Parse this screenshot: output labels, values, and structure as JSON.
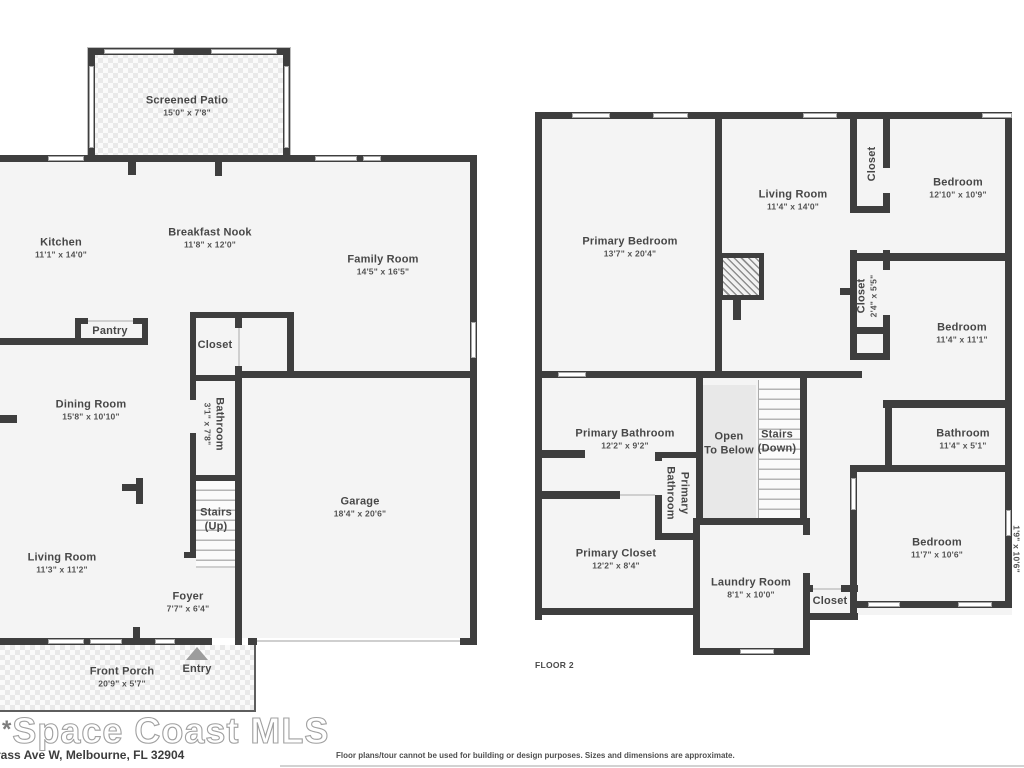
{
  "floor1": {
    "rooms": {
      "screened_patio": {
        "name": "Screened Patio",
        "dims": "15'0\" x 7'8\""
      },
      "kitchen": {
        "name": "Kitchen",
        "dims": "11'1\" x 14'0\""
      },
      "breakfast_nook": {
        "name": "Breakfast Nook",
        "dims": "11'8\" x 12'0\""
      },
      "family_room": {
        "name": "Family Room",
        "dims": "14'5\" x 16'5\""
      },
      "pantry": {
        "name": "Pantry"
      },
      "closet": {
        "name": "Closet"
      },
      "dining_room": {
        "name": "Dining Room",
        "dims": "15'8\" x 10'10\""
      },
      "bathroom": {
        "name": "Bathroom",
        "dims": "3'1\" x 7'8\""
      },
      "stairs": {
        "name": "Stairs",
        "dims": "(Up)"
      },
      "garage": {
        "name": "Garage",
        "dims": "18'4\" x 20'6\""
      },
      "living_room": {
        "name": "Living Room",
        "dims": "11'3\" x 11'2\""
      },
      "foyer": {
        "name": "Foyer",
        "dims": "7'7\" x 6'4\""
      },
      "front_porch": {
        "name": "Front Porch",
        "dims": "20'9\" x 5'7\""
      },
      "entry": {
        "name": "Entry"
      }
    }
  },
  "floor2": {
    "floor_label": "FLOOR 2",
    "rooms": {
      "primary_bedroom": {
        "name": "Primary Bedroom",
        "dims": "13'7\" x 20'4\""
      },
      "living_room": {
        "name": "Living Room",
        "dims": "11'4\" x 14'0\""
      },
      "closet_top": {
        "name": "Closet"
      },
      "bedroom_top": {
        "name": "Bedroom",
        "dims": "12'10\" x 10'9\""
      },
      "closet_mid": {
        "name": "Closet",
        "dims": "2'4\" x 5'5\""
      },
      "bedroom_mid": {
        "name": "Bedroom",
        "dims": "11'4\" x 11'1\""
      },
      "primary_bathroom": {
        "name": "Primary Bathroom",
        "dims": "12'2\" x 9'2\""
      },
      "primary_bathroom_small": {
        "line1": "Primary",
        "line2": "Bathroom"
      },
      "open_to_below": {
        "line1": "Open",
        "line2": "To Below"
      },
      "stairs": {
        "name": "Stairs",
        "dims": "(Down)"
      },
      "bathroom": {
        "name": "Bathroom",
        "dims": "11'4\" x 5'1\""
      },
      "primary_closet": {
        "name": "Primary Closet",
        "dims": "12'2\" x 8'4\""
      },
      "laundry_room": {
        "name": "Laundry Room",
        "dims": "8'1\" x 10'0\""
      },
      "closet_laundry": {
        "name": "Closet"
      },
      "bedroom_bottom": {
        "name": "Bedroom",
        "dims": "11'7\" x 10'6\""
      },
      "side_nook": {
        "dims": "1'9\" x 10'6\""
      }
    }
  },
  "footer": {
    "logo_mark": "*",
    "logo_text": "Space Coast MLS",
    "address": "rass Ave W, Melbourne, FL 32904",
    "disclaimer": "Floor plans/tour cannot be used for building or design purposes. Sizes and dimensions are approximate."
  }
}
